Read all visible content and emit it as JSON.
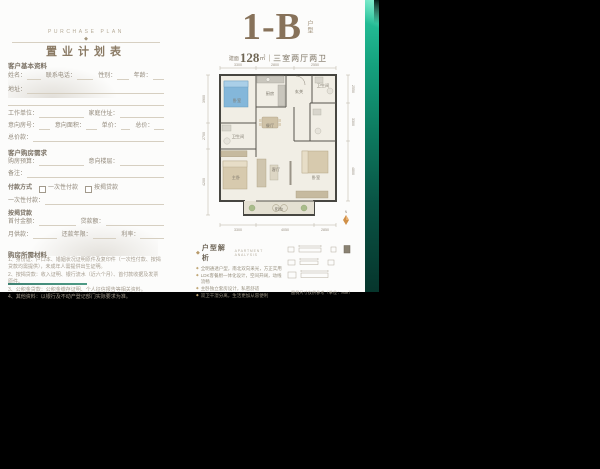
{
  "colors": {
    "teal": "#17bb92",
    "teal_dark": "#07352b",
    "bronze": "#8a7358",
    "page": "#fcfcfb"
  },
  "form": {
    "brand_caps": "PURCHASE PLAN",
    "ornament_glyph": "◆",
    "title": "置业计划表",
    "basic": {
      "header": "客户基本资料",
      "name": "姓名：",
      "phone": "联系电话：",
      "gender": "性别：",
      "age": "年龄：",
      "address": "地址：",
      "work": "工作单位：",
      "home": "家庭住址：",
      "unit_no": "意向房号：",
      "area": "意向面积：",
      "price": "单价：",
      "total": "总价：",
      "total_amount": "总价款："
    },
    "demand": {
      "header": "客户购房需求",
      "budget": "购房预算：",
      "floor": "意向楼层：",
      "note": "备注："
    },
    "payment": {
      "label": "付款方式",
      "opt_lump": "一次性付款",
      "opt_mortgage": "按揭贷款",
      "lump_line": "一次性付款：",
      "mortgage_header": "按揭贷款",
      "down": "首付金额：",
      "loan": "贷款额：",
      "monthly": "月供款：",
      "years": "还款年限：",
      "rate": "利率："
    },
    "materials": {
      "header": "购房所需材料",
      "lines": [
        "1、身份证、户口本、婚姻状况证明原件及复印件（一次性付款、按揭贷款均需提供），未成年人需提供出生证明。",
        "2、按揭贷款：收入证明、银行流水（近六个月）、首付款收据及发票原件。",
        "3、公积金贷款：公积金缴存证明、个人征信报告等相关资料。",
        "4、其他资料：以银行及不动产登记部门实际要求为准。"
      ]
    }
  },
  "plan": {
    "unit": "1-B",
    "unit_tag": "户型",
    "area_prefix": "建面",
    "area_value": "128",
    "area_unit": "㎡",
    "divider": "|",
    "layout_desc": "三室两厅两卫",
    "rooms": {
      "bedroom_tl": "卧室",
      "bath1": "卫生间",
      "master": "主卧",
      "kitchen": "厨房",
      "foyer": "玄关",
      "bath2": "卫生间",
      "dining": "餐厅",
      "living": "客厅",
      "bedroom_r": "卧室",
      "balcony": "阳台"
    },
    "dims": {
      "top": [
        "3300",
        "2800",
        "2550"
      ],
      "bottom": [
        "3300",
        "4050",
        "2850"
      ],
      "left": [
        "3900",
        "2700",
        "4200"
      ],
      "right": [
        "2550",
        "3300",
        "4800"
      ]
    },
    "analysis": {
      "diamond": "◆",
      "header": "户型解析",
      "header_en": "APARTMENT ANALYSIS",
      "bullets": [
        "全明通透户型，南北双向采光，方正实用",
        "LDK客餐厨一体化设计，空间开阔，动线流畅",
        "主卧独立套房设计，私密舒适",
        "双卫干湿分离，生活更加从容便利"
      ]
    },
    "legend_caption": "图例尺寸仅供参考（单位：mm）",
    "compass": "N"
  }
}
